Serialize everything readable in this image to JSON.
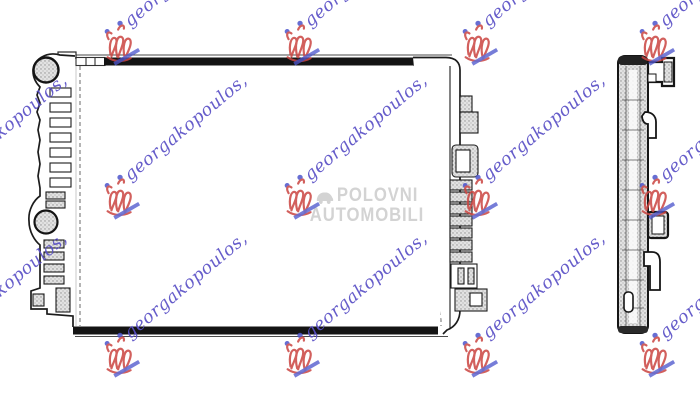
{
  "watermark_signature": {
    "text": "georgakopoulos,",
    "text_color": "#5a50c6",
    "logo_red": "#cb4541",
    "logo_blue": "#4d55cc",
    "positions": [
      {
        "x": -80,
        "y": 18
      },
      {
        "x": 100,
        "y": 18
      },
      {
        "x": 280,
        "y": 18
      },
      {
        "x": 458,
        "y": 18
      },
      {
        "x": 635,
        "y": 18
      },
      {
        "x": -80,
        "y": 172
      },
      {
        "x": 100,
        "y": 172
      },
      {
        "x": 280,
        "y": 172
      },
      {
        "x": 458,
        "y": 172
      },
      {
        "x": 635,
        "y": 172
      },
      {
        "x": -80,
        "y": 330
      },
      {
        "x": 100,
        "y": 330
      },
      {
        "x": 280,
        "y": 330
      },
      {
        "x": 458,
        "y": 330
      },
      {
        "x": 635,
        "y": 330
      }
    ]
  },
  "watermark_center": {
    "line1": "POLOVNI",
    "line2": "AUTOMOBILI",
    "color": "#cfcfcf"
  },
  "drawing": {
    "ink_color": "#1c1c1c",
    "background": "#ffffff"
  }
}
